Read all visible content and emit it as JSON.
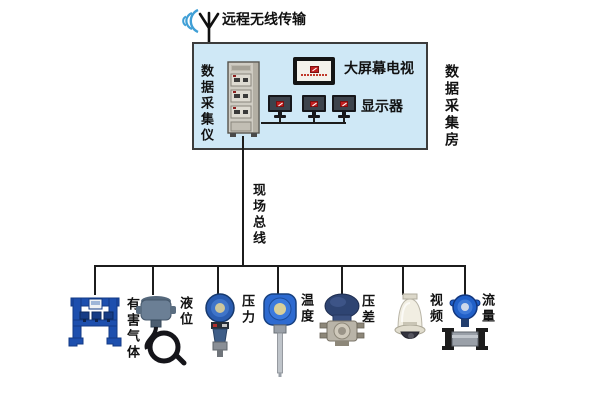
{
  "wireless": {
    "label": "远程无线传输"
  },
  "room": {
    "label": "数据采集房",
    "cabinet_label": "数据采集仪",
    "tv_label": "大屏幕电视",
    "monitors_label": "显示器"
  },
  "bus": {
    "label": "现场总线"
  },
  "devices": [
    {
      "id": "harmful-gas",
      "label": "有害气体"
    },
    {
      "id": "liquid-level",
      "label": "液位"
    },
    {
      "id": "pressure",
      "label": "压力"
    },
    {
      "id": "temperature",
      "label": "温度"
    },
    {
      "id": "diff-pressure",
      "label": "压差"
    },
    {
      "id": "video",
      "label": "视频"
    },
    {
      "id": "flow",
      "label": "流量"
    }
  ],
  "colors": {
    "room_bg": "#cfe8f6",
    "room_border": "#3c3c3c",
    "line": "#1c1c1c",
    "wave_blue": "#3f9fd6",
    "device_blue": "#2a5cb0",
    "logo_red": "#c01f1f"
  }
}
